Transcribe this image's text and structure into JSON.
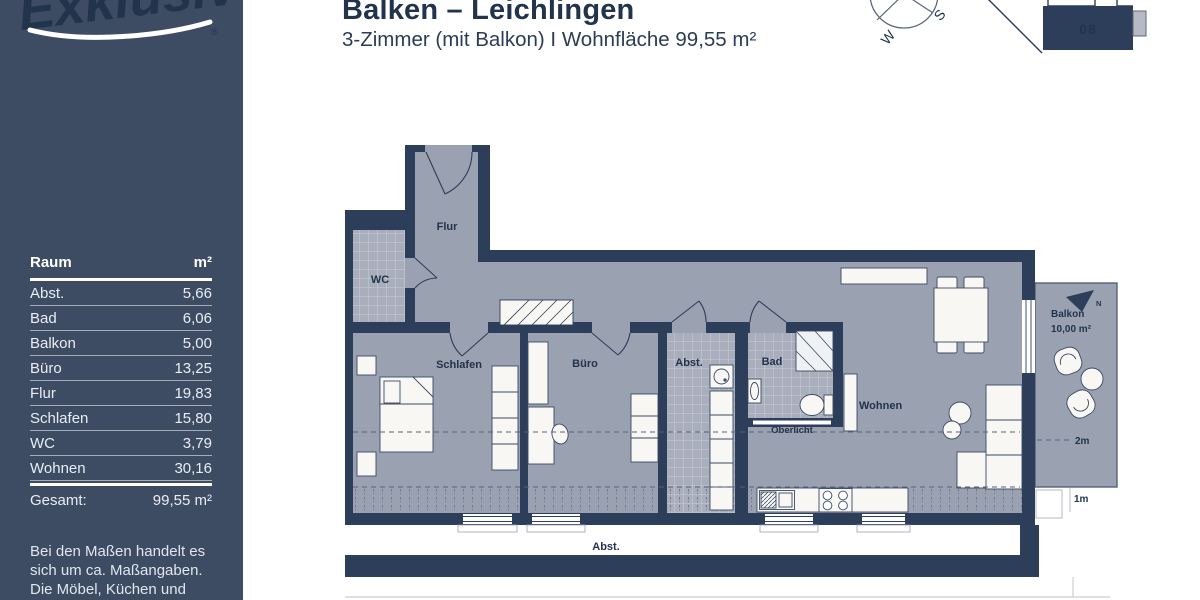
{
  "sidebar": {
    "logo": {
      "text": "Exklusiv",
      "registered_mark": "®"
    },
    "table": {
      "header": {
        "room": "Raum",
        "area": "m²"
      },
      "rows": [
        {
          "name": "Abst.",
          "area": "5,66"
        },
        {
          "name": "Bad",
          "area": "6,06"
        },
        {
          "name": "Balkon",
          "area": "5,00"
        },
        {
          "name": "Büro",
          "area": "13,25"
        },
        {
          "name": "Flur",
          "area": "19,83"
        },
        {
          "name": "Schlafen",
          "area": "15,80"
        },
        {
          "name": "WC",
          "area": "3,79"
        },
        {
          "name": "Wohnen",
          "area": "30,16"
        }
      ],
      "total": {
        "label": "Gesamt:",
        "value": "99,55 m²"
      }
    },
    "note_lines": [
      "Bei den Maßen handelt es",
      "sich um ca. Maßangaben.",
      "Die Möbel, Küchen und",
      "Sanitärobjekte sind"
    ]
  },
  "header": {
    "title": "Balken – Leichlingen",
    "subtitle": "3-Zimmer (mit Balkon) I Wohnfläche 99,55 m²"
  },
  "compass": {
    "west": "W",
    "south": "S"
  },
  "site_plan": {
    "unit_number": "08"
  },
  "floor_plan": {
    "rooms": {
      "flur": "Flur",
      "wc": "WC",
      "schlafen": "Schlafen",
      "buero": "Büro",
      "abstell": "Abst.",
      "bad": "Bad",
      "wohnen": "Wohnen",
      "oberlicht": "Oberlicht"
    },
    "balcony": {
      "label": "Balkon",
      "area": "10,00 m²"
    },
    "north_letter": "N",
    "measures": {
      "two_m": "2m",
      "one_m": "1m"
    },
    "exterior_storage": "Abst.",
    "colors": {
      "wall": "#2c3e59",
      "floor": "#9aa1b1",
      "tile": "#a8aebc",
      "sidebar": "#3d4b63",
      "text": "#22344c",
      "furniture": "#f8f7f4"
    }
  }
}
